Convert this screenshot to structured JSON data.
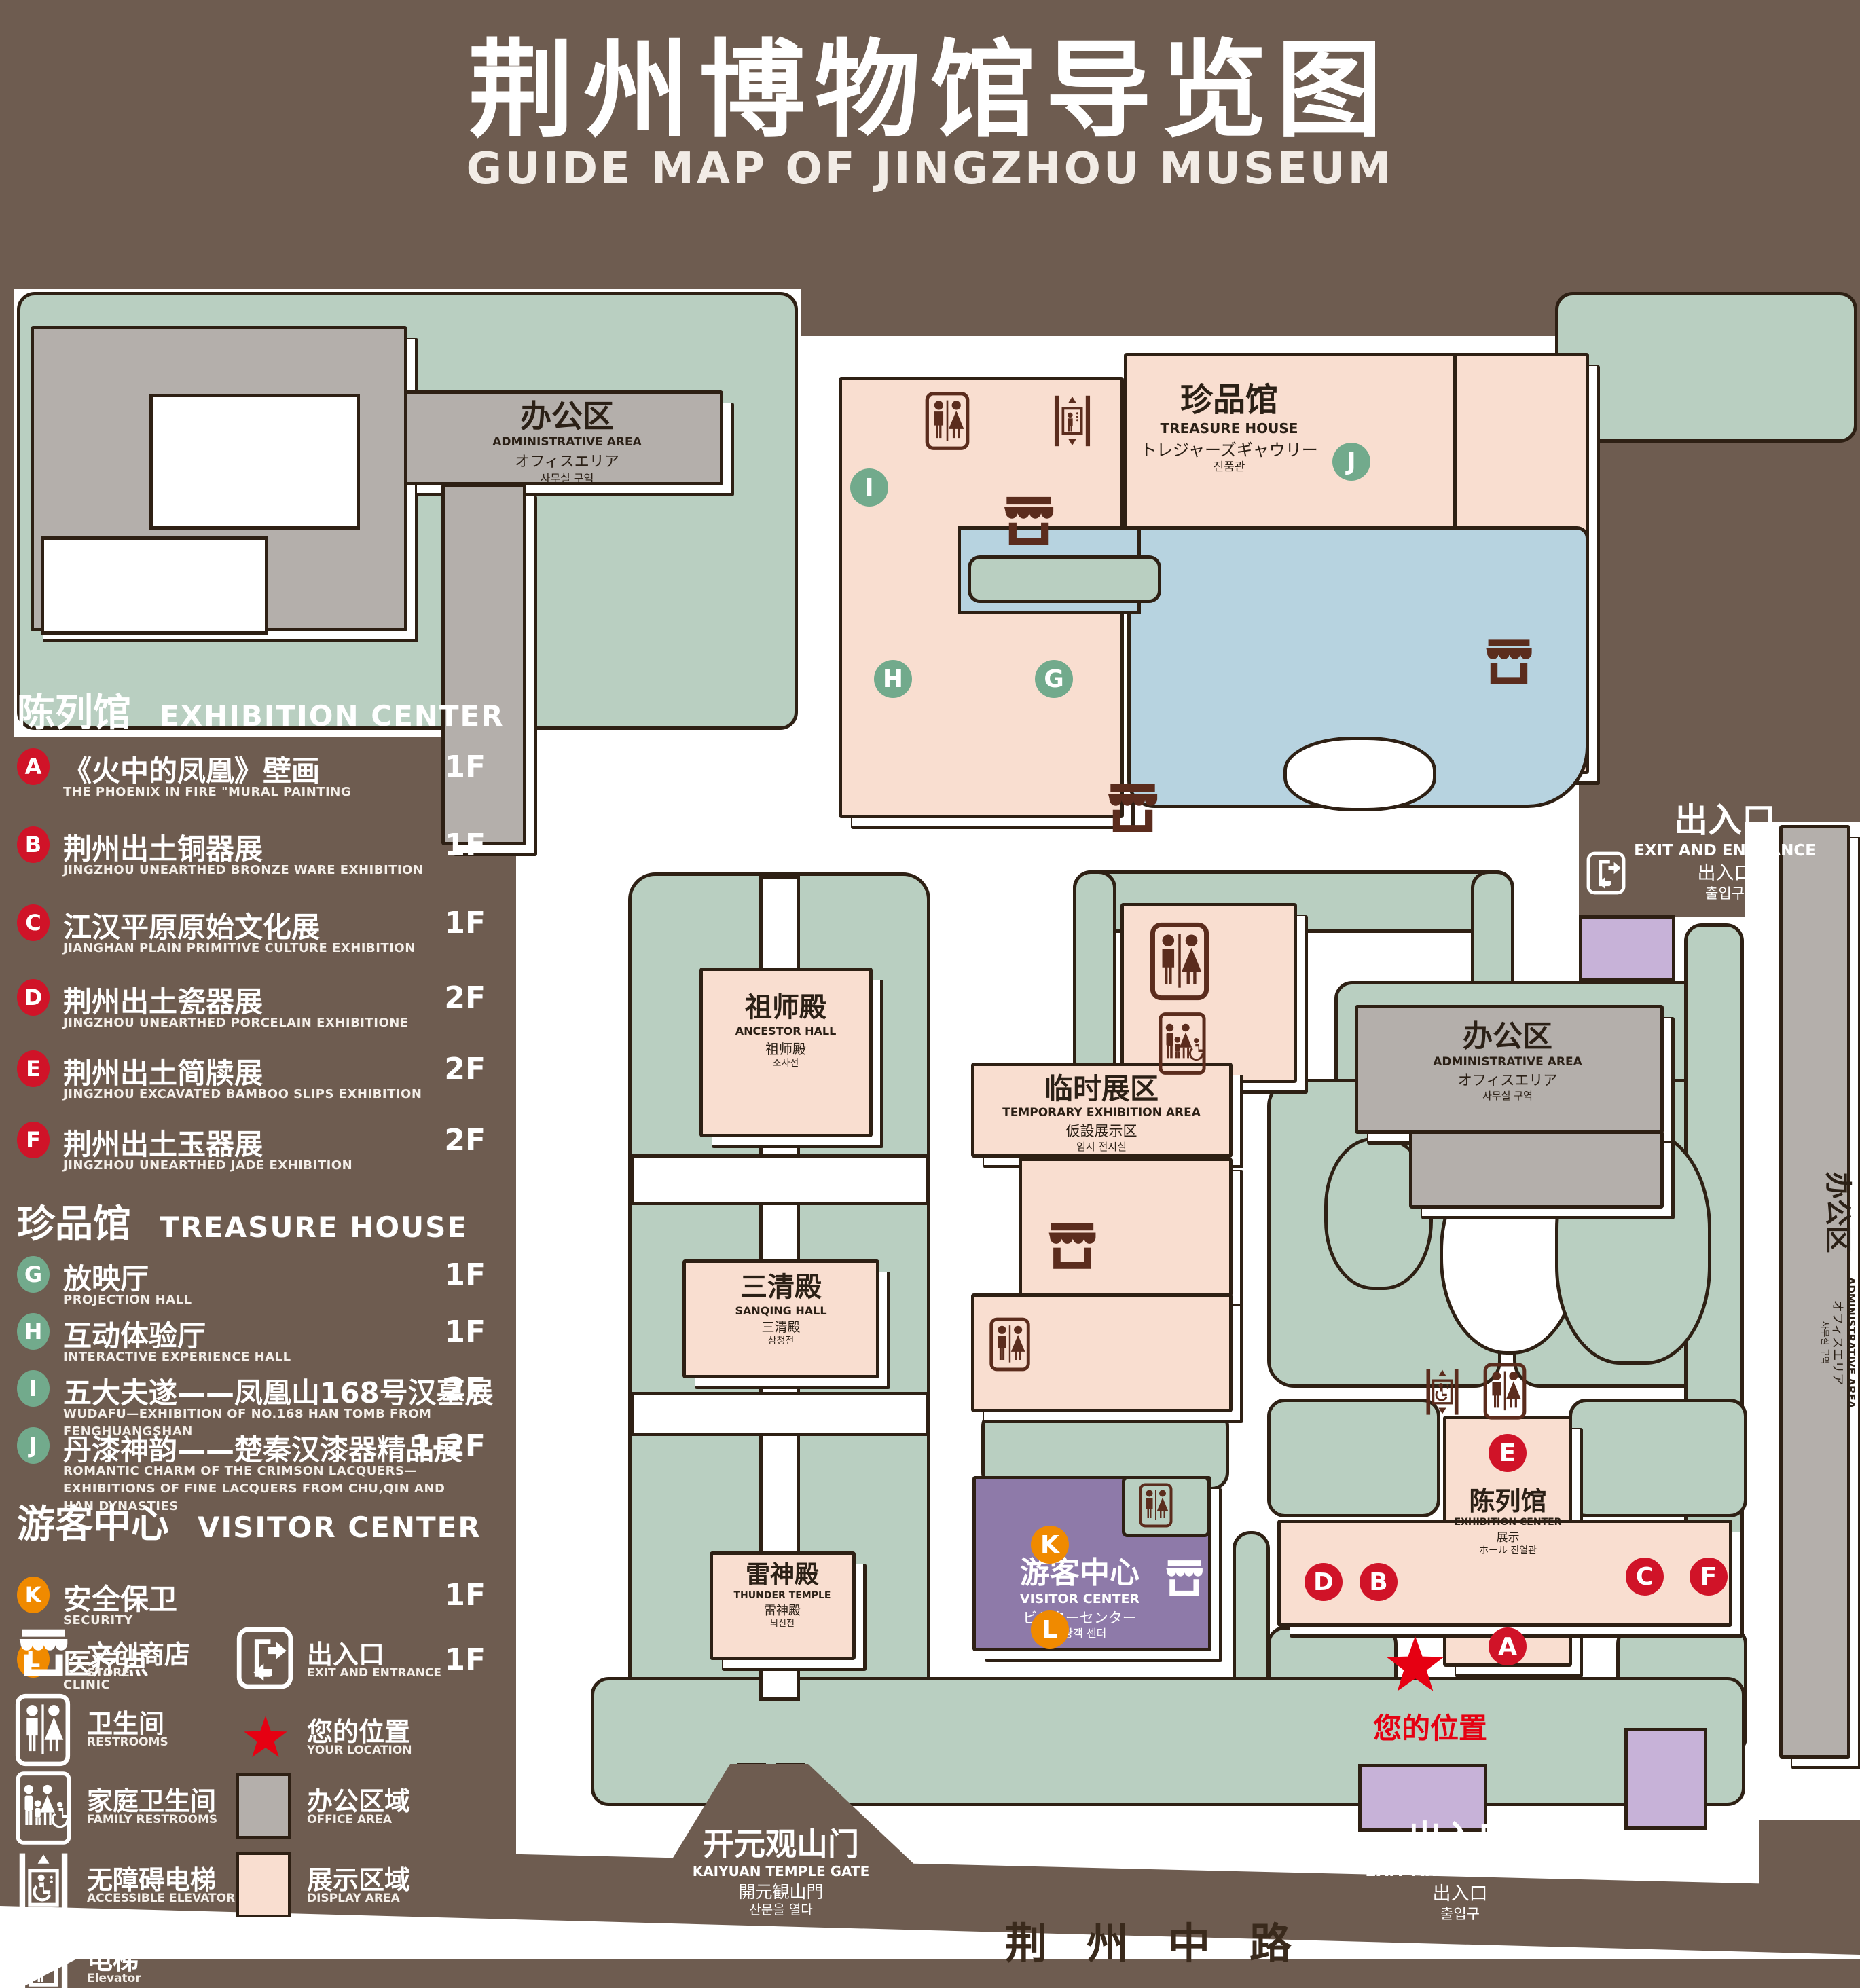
{
  "title": {
    "zh": "荆州博物馆导览图",
    "en": "GUIDE MAP OF JINGZHOU MUSEUM"
  },
  "legend": {
    "sections": [
      {
        "title_zh": "陈列馆",
        "title_en": "EXHIBITION CENTER",
        "badge": "red",
        "items": [
          {
            "letter": "A",
            "zh": "《火中的凤凰》壁画",
            "en": "THE PHOENIX IN FIRE \"MURAL PAINTING",
            "floor": "1F"
          },
          {
            "letter": "B",
            "zh": "荆州出土铜器展",
            "en": "JINGZHOU UNEARTHED BRONZE WARE EXHIBITION",
            "floor": "1F"
          },
          {
            "letter": "C",
            "zh": "江汉平原原始文化展",
            "en": "JIANGHAN PLAIN PRIMITIVE CULTURE EXHIBITION",
            "floor": "1F"
          },
          {
            "letter": "D",
            "zh": "荆州出土瓷器展",
            "en": "JINGZHOU UNEARTHED PORCELAIN EXHIBITIONE",
            "floor": "2F"
          },
          {
            "letter": "E",
            "zh": "荆州出土简牍展",
            "en": "JINGZHOU EXCAVATED BAMBOO SLIPS EXHIBITION",
            "floor": "2F"
          },
          {
            "letter": "F",
            "zh": "荆州出土玉器展",
            "en": "JINGZHOU UNEARTHED JADE EXHIBITION",
            "floor": "2F"
          }
        ]
      },
      {
        "title_zh": "珍品馆",
        "title_en": "TREASURE HOUSE",
        "badge": "green",
        "items": [
          {
            "letter": "G",
            "zh": "放映厅",
            "en": "PROJECTION HALL",
            "floor": "1F"
          },
          {
            "letter": "H",
            "zh": "互动体验厅",
            "en": "INTERACTIVE EXPERIENCE HALL",
            "floor": "1F"
          },
          {
            "letter": "I",
            "zh": "五大夫遂——凤凰山168号汉墓展",
            "en": "WUDAFU—EXHIBITION OF NO.168 HAN TOMB FROM FENGHUANGSHAN",
            "floor": "2F"
          },
          {
            "letter": "J",
            "zh": "丹漆神韵——楚秦汉漆器精品展",
            "en": "ROMANTIC CHARM OF THE CRIMSON LACQUERS—EXHIBITIONS OF FINE LACQUERS FROM CHU,QIN AND HAN DYNASTIES",
            "floor": "1-2F"
          }
        ]
      },
      {
        "title_zh": "游客中心",
        "title_en": "VISITOR CENTER",
        "badge": "orange",
        "items": [
          {
            "letter": "K",
            "zh": "安全保卫",
            "en": "SECURITY",
            "floor": "1F"
          },
          {
            "letter": "L",
            "zh": "医疗点",
            "en": "CLINIC",
            "floor": "1F"
          }
        ]
      }
    ],
    "symbols": {
      "store": {
        "zh": "文创商店",
        "en": "STORE"
      },
      "restrooms": {
        "zh": "卫生间",
        "en": "RESTROOMS"
      },
      "family_restrooms": {
        "zh": "家庭卫生间",
        "en": "FAMILY RESTROOMS"
      },
      "accessible_elevator": {
        "zh": "无障碍电梯",
        "en": "ACCESSIBLE ELEVATOR"
      },
      "elevator": {
        "zh": "电梯",
        "en": "Elevator"
      },
      "exit": {
        "zh": "出入口",
        "en": "EXIT AND ENTRANCE"
      },
      "your_location": {
        "zh": "您的位置",
        "en": "YOUR LOCATION"
      },
      "office_area": {
        "zh": "办公区域",
        "en": "OFFICE AREA"
      },
      "display_area": {
        "zh": "展示区域",
        "en": "DISPLAY AREA"
      }
    }
  },
  "map": {
    "admin": {
      "zh": "办公区",
      "en": "ADMINISTRATIVE AREA",
      "ja": "オフィスエリア",
      "ko": "사무실 구역"
    },
    "treasure_house": {
      "zh": "珍品馆",
      "en": "TREASURE HOUSE",
      "ja": "トレジャーズギャウリー",
      "ko": "진품관"
    },
    "ancestor_hall": {
      "zh": "祖师殿",
      "en": "ANCESTOR HALL",
      "ja": "祖师殿",
      "ko": "조사전"
    },
    "temporary_area": {
      "zh": "临时展区",
      "en": "TEMPORARY EXHIBITION AREA",
      "ja": "仮設展示区",
      "ko": "임시 전시실"
    },
    "sanqing_hall": {
      "zh": "三清殿",
      "en": "SANQING HALL",
      "ja": "三清殿",
      "ko": "삼청전"
    },
    "thunder_temple": {
      "zh": "雷神殿",
      "en": "THUNDER TEMPLE",
      "ja": "雷神殿",
      "ko": "뇌신전"
    },
    "visitor_center": {
      "zh": "游客中心",
      "en": "VISITOR CENTER",
      "ja": "ビジターセンター",
      "ko": "관광객 센터"
    },
    "exhibition_center": {
      "zh": "陈列馆",
      "en": "EXHIBITION CENTER",
      "ja": "展示",
      "ko": "ホール 진열관"
    },
    "gate": {
      "zh": "开元观山门",
      "en": "KAIYUAN TEMPLE GATE",
      "ja": "開元観山門",
      "ko": "산문을 열다"
    },
    "exit": {
      "zh": "出入口",
      "en": "EXIT AND ENTRANCE",
      "zh2": "出入口",
      "ko": "출입구"
    },
    "your_location": "您的位置",
    "road": "荆州中路",
    "badges": {
      "red": [
        "A",
        "B",
        "C",
        "D",
        "E",
        "F"
      ],
      "green": [
        "G",
        "H",
        "I",
        "J"
      ],
      "orange": [
        "K",
        "L"
      ]
    }
  },
  "colors": {
    "background": "#6e5c50",
    "garden": "#b9cfc1",
    "display_area": "#f9ded0",
    "office_area": "#b4afab",
    "visitor_center": "#8e7aa9",
    "gate": "#c7b2d8",
    "pond": "#b7d3e0",
    "outline": "#2e2014",
    "badge_red": "#d01328",
    "badge_green": "#72aa8c",
    "badge_orange": "#f08a00",
    "icon_dark": "#5b2c1d",
    "location_red": "#e60012"
  }
}
